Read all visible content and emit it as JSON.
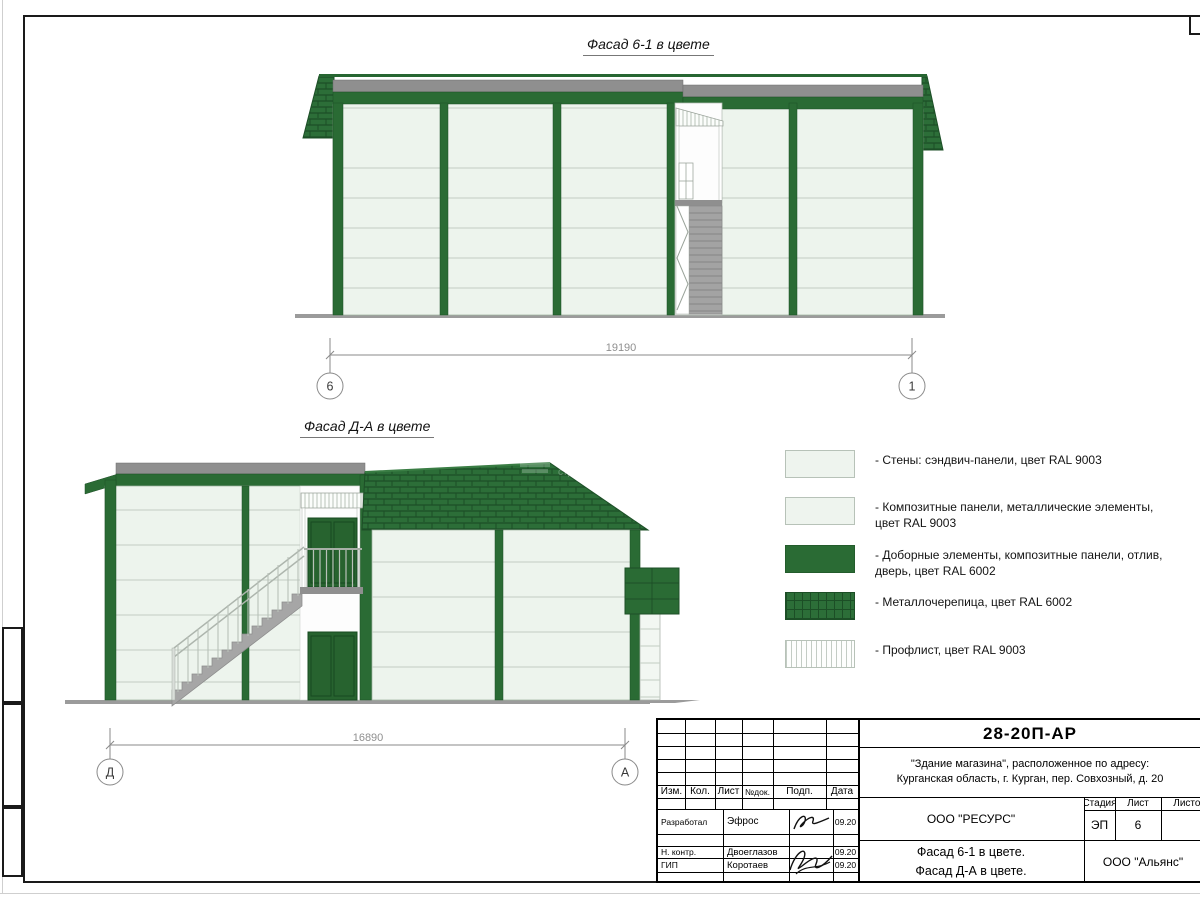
{
  "facade1": {
    "title": "Фасад 6-1 в цвете",
    "dimension": "19190",
    "axis_left": "6",
    "axis_right": "1"
  },
  "facade2": {
    "title": "Фасад Д-А в цвете",
    "dimension": "16890",
    "axis_left": "Д",
    "axis_right": "А",
    "watermark": "строительна"
  },
  "legend": {
    "items": [
      {
        "swatch": "wall-sandwich-panel",
        "label": "- Стены: сэндвич-панели, цвет RAL 9003"
      },
      {
        "swatch": "composite-panel",
        "label": "- Композитные панели, металлические элементы, цвет RAL 9003"
      },
      {
        "swatch": "trim-elements-green",
        "label": "- Доборные элементы,  композитные панели, отлив, дверь, цвет RAL 6002"
      },
      {
        "swatch": "metal-tile-roof",
        "label": "- Металлочерепица, цвет RAL 6002"
      },
      {
        "swatch": "profiled-sheet",
        "label": "- Профлист, цвет RAL 9003"
      }
    ]
  },
  "titleblock": {
    "doc_number": "28-20П-АР",
    "address_line1": "\"Здание магазина\", расположенное по адресу:",
    "address_line2": "Курганская область, г. Курган, пер. Совхозный, д. 20",
    "header_cols": [
      "Изм.",
      "Кол.",
      "Лист",
      "№док.",
      "Подп.",
      "Дата"
    ],
    "sign_rows": [
      {
        "role": "Разработал",
        "name": "Эфрос",
        "date": "09.20"
      },
      {
        "role": "Н. контр.",
        "name": "Двоеглазов",
        "date": "09.20"
      },
      {
        "role": "ГИП",
        "name": "Коротаев",
        "date": "09.20"
      }
    ],
    "designer_org": "ООО \"РЕСУРС\"",
    "customer_org": "ООО \"Альянс\"",
    "sheet_title_line1": "Фасад 6-1 в цвете.",
    "sheet_title_line2": "Фасад Д-А в цвете.",
    "stage_label": "Стадия",
    "stage_value": "ЭП",
    "sheet_label": "Лист",
    "sheet_value": "6",
    "sheets_label": "Листов",
    "sheets_value": ""
  },
  "colors": {
    "green_main": "#2a6b34",
    "green_dark": "#1d4f27",
    "panel_light": "#edf4ed",
    "panel_line": "#c2cdc3",
    "gray_strip": "#8f8f8f",
    "stair_gray": "#a3a3a3",
    "dim_gray": "#8a8a8a"
  }
}
